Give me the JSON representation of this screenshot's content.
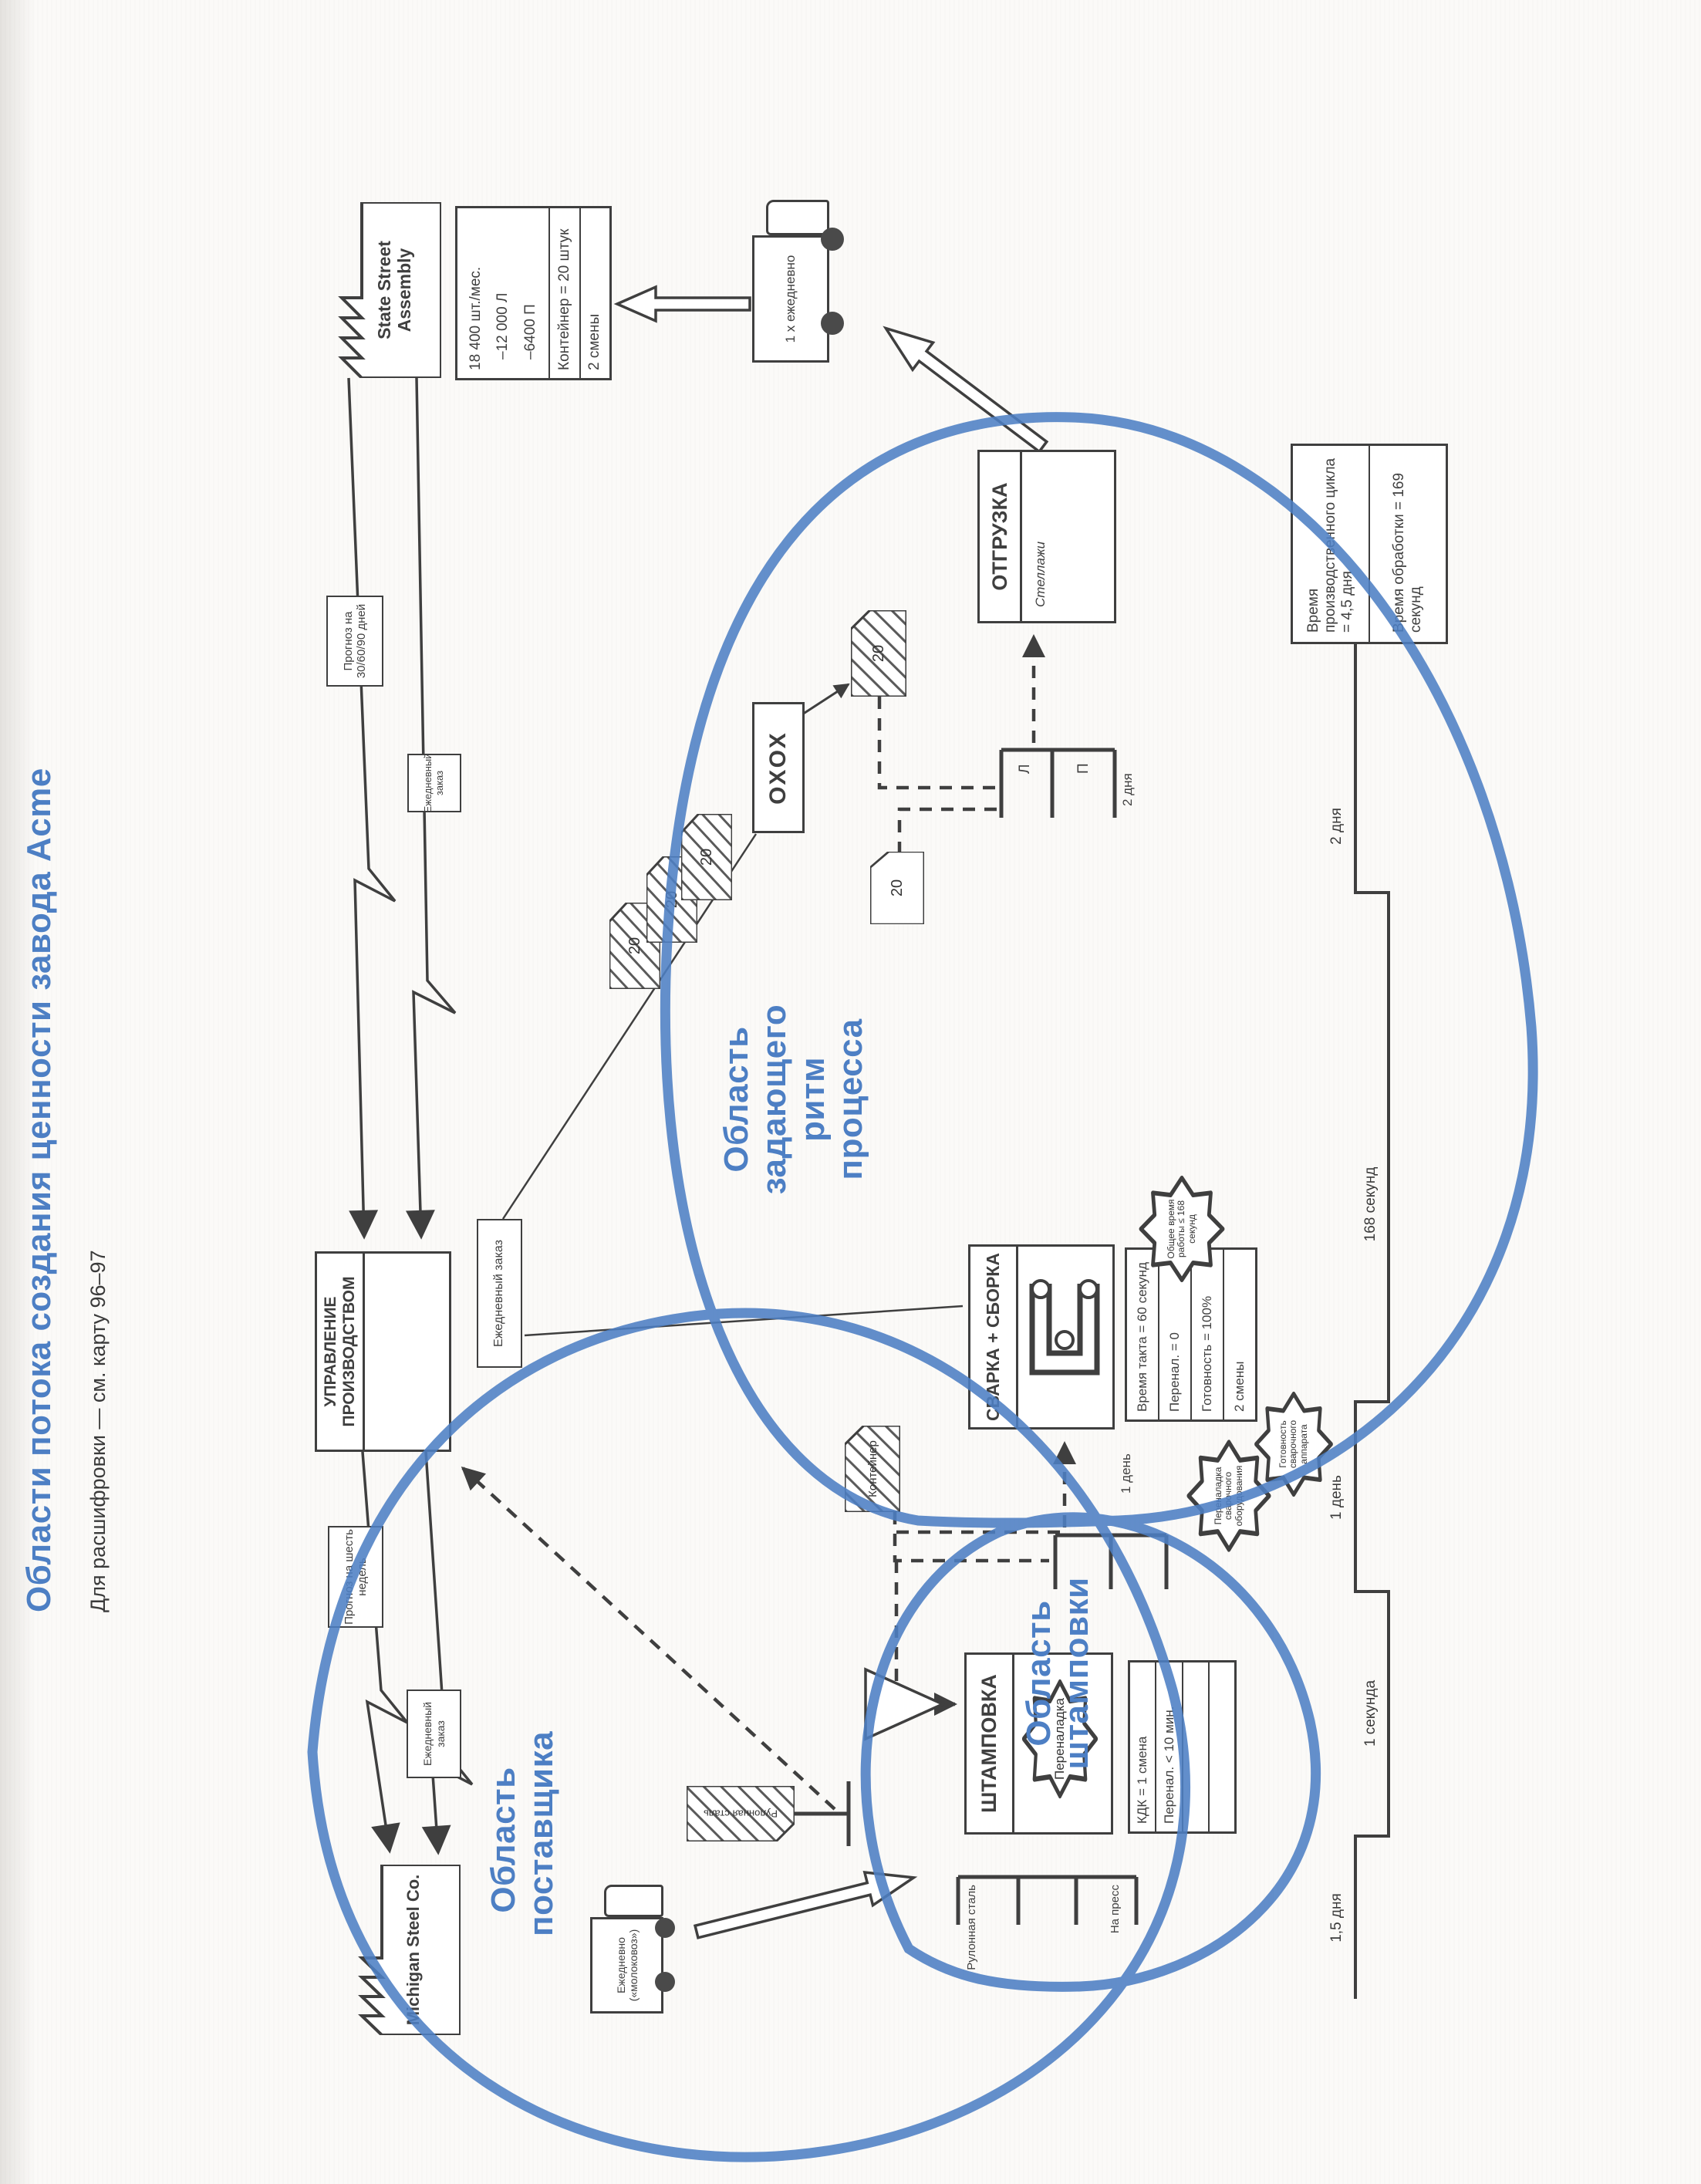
{
  "page": {
    "title": "Области потока создания ценности завода Acme",
    "subtitle": "Для расшифровки — см. карту 96–97"
  },
  "customer": {
    "factory": "State Street Assembly",
    "databox": {
      "demand": "18 400 шт./мес.",
      "left": "–12 000 Л",
      "right": "–6400 П",
      "container": "Контейнер = 20 штук",
      "shifts": "2 смены"
    },
    "truck": "1 х ежедневно"
  },
  "supplier": {
    "factory": "Michigan Steel Co.",
    "truck": "Ежедневно («молоковоз»)"
  },
  "production_control": {
    "title": "УПРАВЛЕНИЕ ПРОИЗВОДСТВОМ",
    "forecast_from_customer": "Прогноз на 30/60/90 дней",
    "order_from_customer": "Ежедневный заказ",
    "forecast_to_supplier": "Прогноз на шесть недель",
    "order_to_supplier": "Ежедневный заказ",
    "order_to_pacemaker": "Ежедневный заказ"
  },
  "leveling_box": "ОХОХ",
  "processes": {
    "stamping": {
      "title": "ШТАМПОВКА",
      "burst": "Переналадка",
      "data": [
        "КДК = 1 смена",
        "Перенал. < 10 мин."
      ]
    },
    "welding": {
      "title": "СВАРКА + СБОРКА",
      "data": [
        "Время такта = 60 секунд",
        "Перенал. = 0",
        "Готовность = 100%",
        "2 смены"
      ]
    },
    "shipping": {
      "title": "ОТГРУЗКА",
      "note": "Стеллажи"
    }
  },
  "supermarkets": {
    "press": {
      "label_top": "Рулонная сталь",
      "label_bottom": "На пресс"
    },
    "interprocess": {
      "inventory": "1 день"
    },
    "finished": {
      "cell_left": "Л",
      "cell_right": "П",
      "inventory": "2 дня"
    }
  },
  "kanban": {
    "batch_cards": [
      "20",
      "20",
      "20"
    ],
    "withdrawal_card": "20",
    "move_card": "20",
    "container_card": "Контейнер",
    "coil_card": "Рулонная сталь"
  },
  "kaizen_bursts": {
    "total_work": "Общее время работы ≤ 168 секунд",
    "welding_changeover": "Переналадка сварочного оборудования",
    "welder_availability": "Готовность сварочного аппарата"
  },
  "regions": {
    "supplier": "Область\nпоставщика",
    "stamping": "Область\nштамповки",
    "pacemaker": "Область\nзадающего ритм\nпроцесса"
  },
  "timeline": {
    "segments": [
      {
        "label": "1,5 дня"
      },
      {
        "label": "1 секунда"
      },
      {
        "label": "1 день"
      },
      {
        "label": "168 секунд"
      },
      {
        "label": "2 дня"
      }
    ],
    "lead_time": "Время производственного цикла = 4,5 дня",
    "process_time": "Время обработки = 169 секунд"
  }
}
